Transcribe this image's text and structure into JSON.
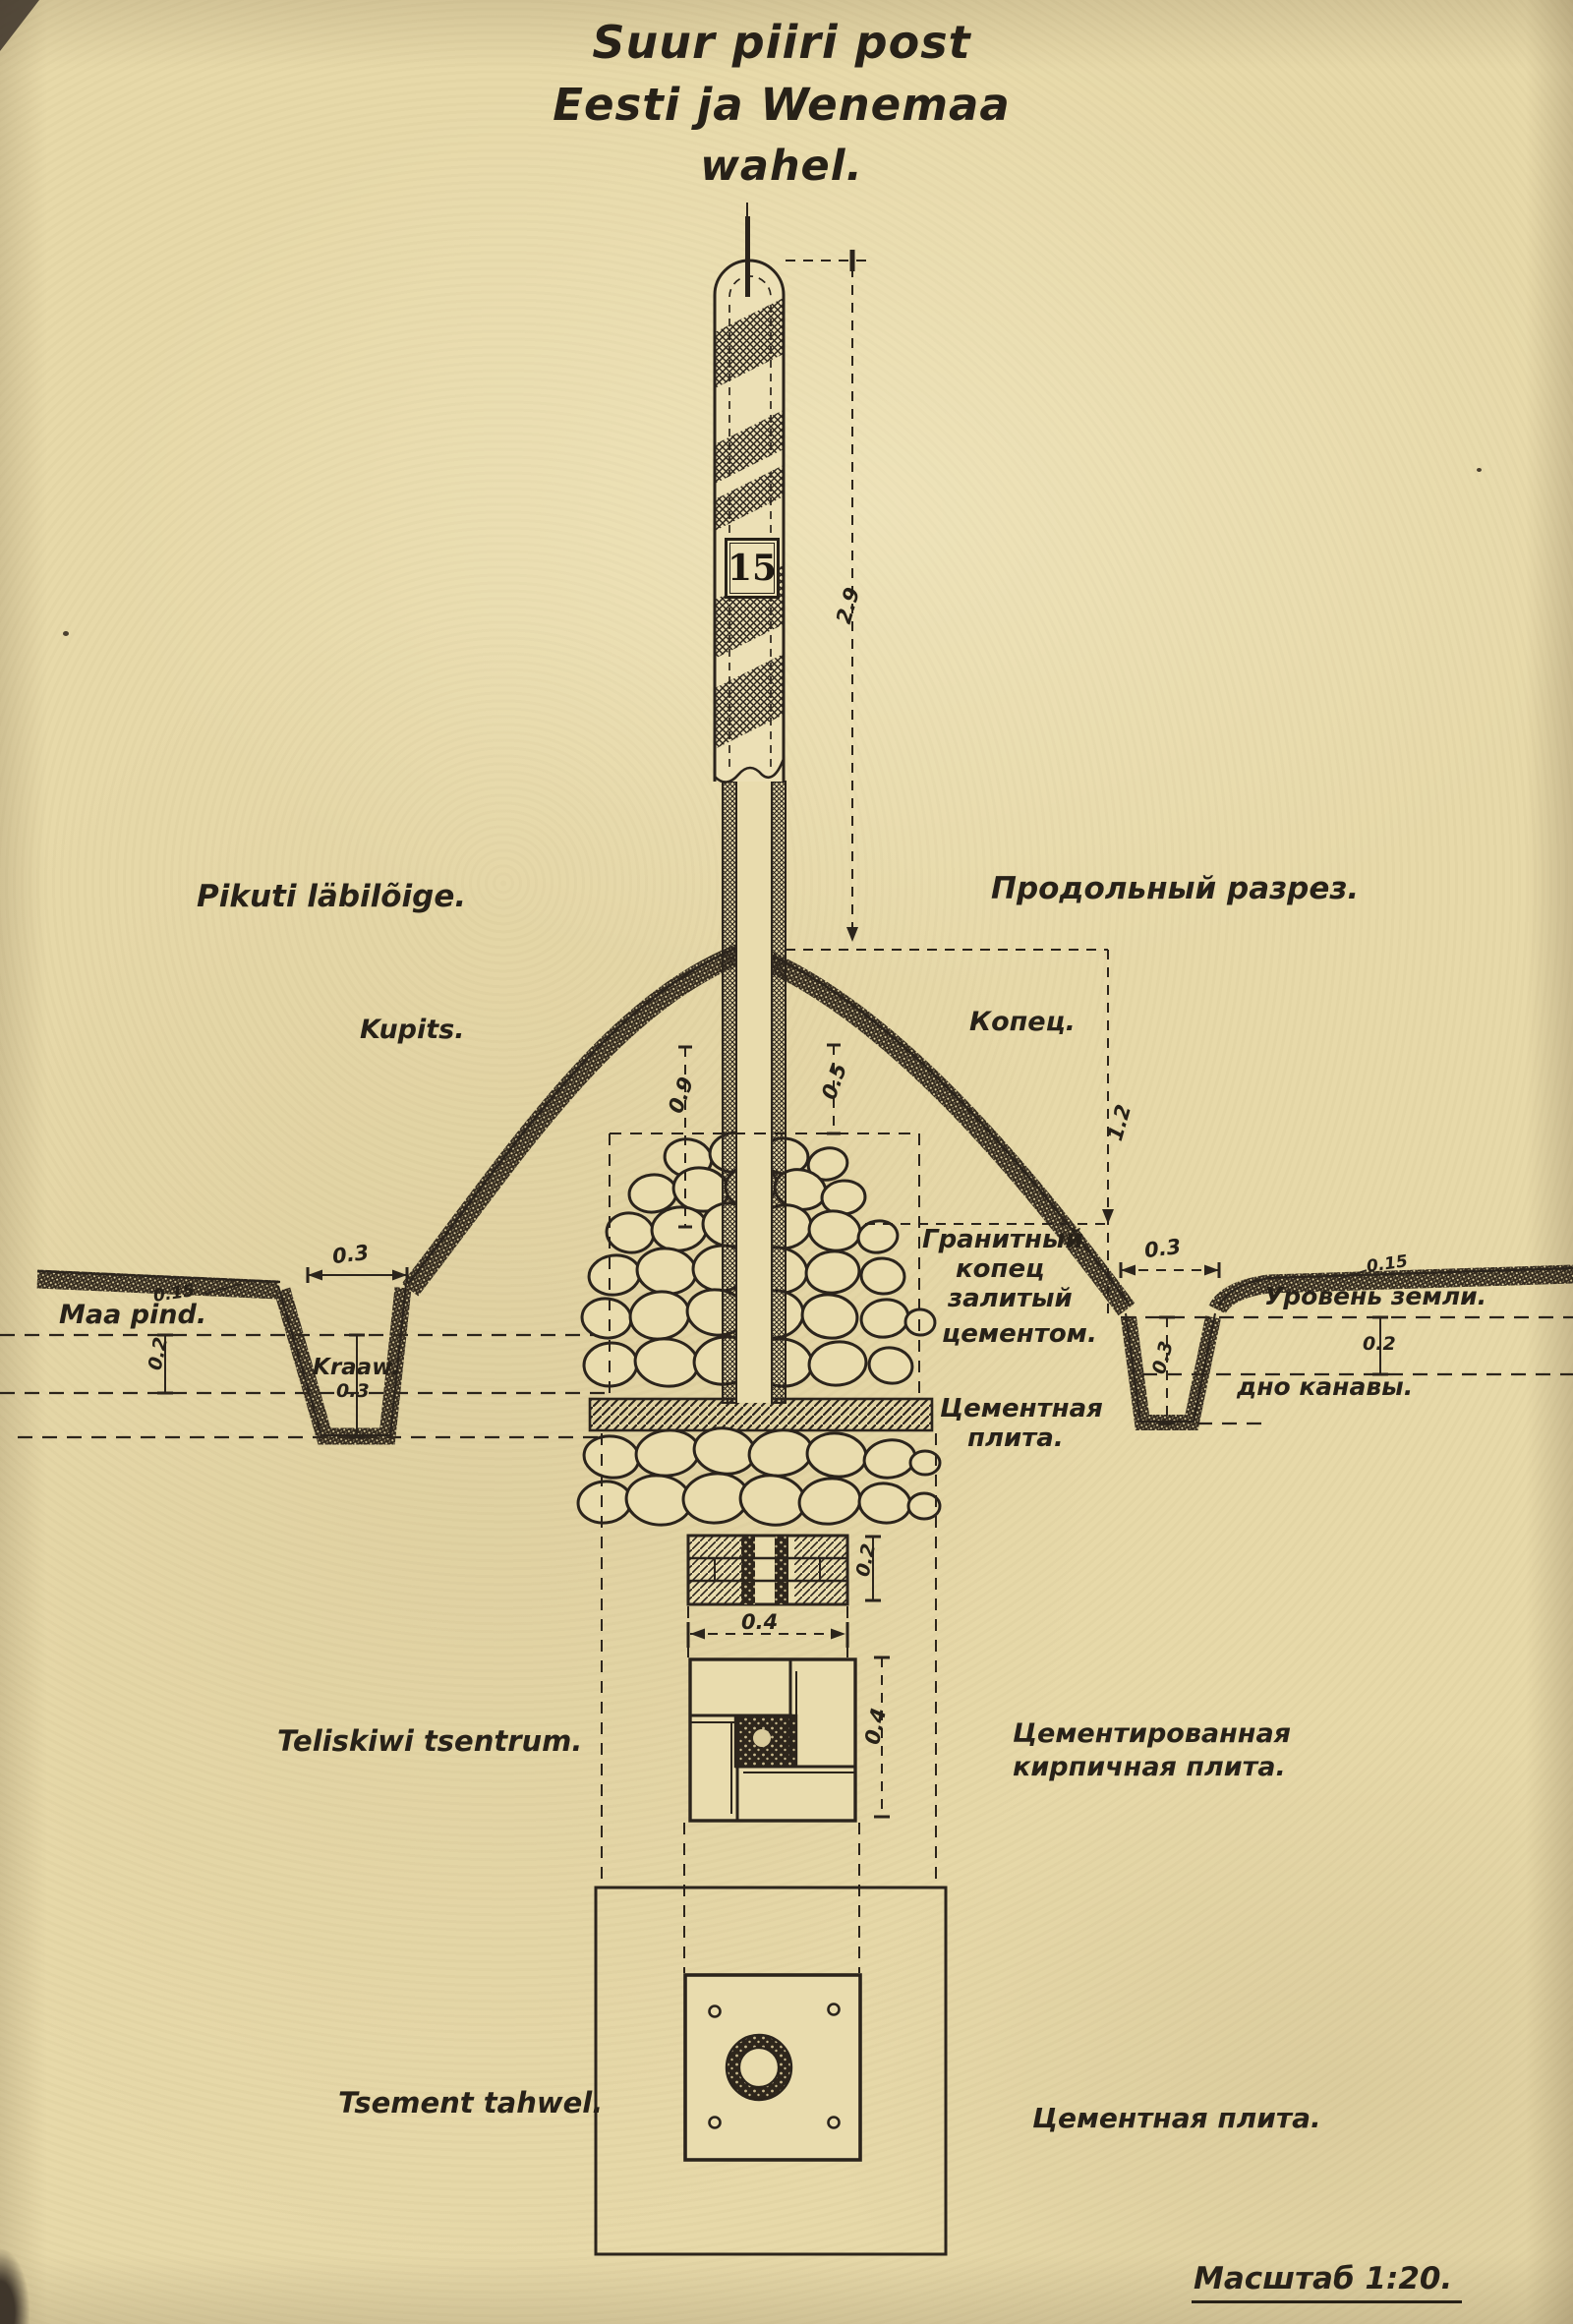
{
  "title": {
    "line1": "Suur piiri post",
    "line2": "Eesti ja Wenemaa",
    "line3": "wahel."
  },
  "post": {
    "number": "15"
  },
  "sections": {
    "left": "Pikuti läbilõige.",
    "right": "Продольный разрез."
  },
  "mound": {
    "left": "Kupits.",
    "right": "Копец."
  },
  "ground": {
    "surface_left": "Maa pind.",
    "ditch_left": "Kraaw.",
    "surface_right": "Уровень земли.",
    "ditch_bottom_right": "дно канавы."
  },
  "core": {
    "granite_l1": "Гранитный",
    "granite_l2": "копец",
    "granite_l3": "залитый",
    "granite_l4": "цементом.",
    "slab_l1": "Цементная",
    "slab_l2": "плита."
  },
  "foundation": {
    "brick_left": "Teliskiwi tsentrum.",
    "brick_right_l1": "Цементированная",
    "brick_right_l2": "кирпичная плита.",
    "board_left": "Tsement tahwel.",
    "slab_right": "Цементная плита."
  },
  "scale_note": "Масштаб 1:20.",
  "dims": {
    "post_height": "2.9",
    "mound_height": "1.2",
    "core_depth": "0.9",
    "stone_top": "0.5",
    "ditch_width_left": "0.3",
    "topsoil_left": "0.15",
    "subsoil_left": "0.2",
    "ditch_depth_left": "0.3",
    "ditch_width_right": "0.3",
    "topsoil_right": "0.15",
    "subsoil_right": "0.2",
    "ditch_depth_right": "0.3",
    "brick_height": "0.2",
    "brick_width": "0.4",
    "plate_size": "0.4"
  },
  "colors": {
    "paper": "#e7d9a9",
    "ink": "#2b241c"
  }
}
